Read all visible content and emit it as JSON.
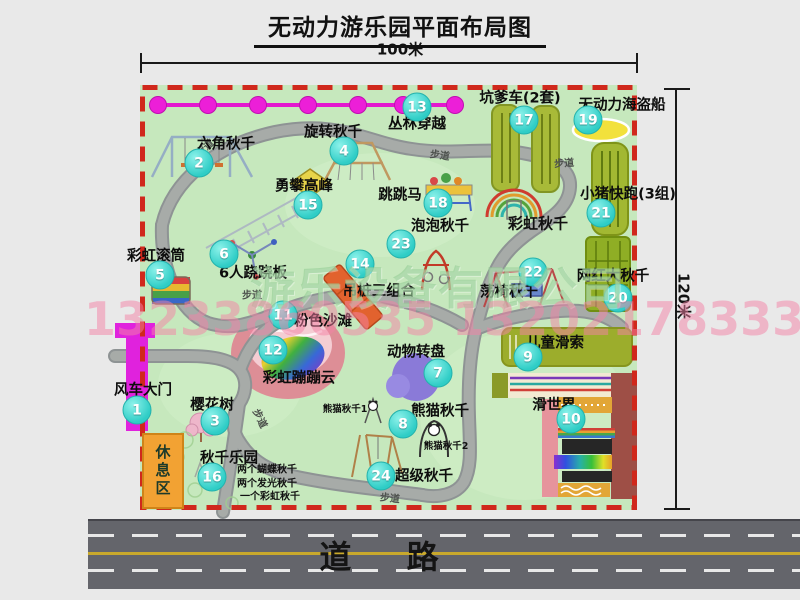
{
  "title": "无动力游乐园平面布局图",
  "dimensions": {
    "top": "100米",
    "right": "120米"
  },
  "road": {
    "label": "道 路"
  },
  "rest_area": {
    "label": "休息区"
  },
  "watermark": {
    "company": "游乐设备有限公司",
    "phone": "13233860535 13202178333"
  },
  "map": {
    "walkway_label": "步道",
    "walkway_label_positions": [
      {
        "x": 64,
        "y": 62,
        "rot": -42
      },
      {
        "x": 300,
        "y": 69,
        "rot": 8
      },
      {
        "x": 424,
        "y": 77,
        "rot": -4
      },
      {
        "x": 112,
        "y": 209,
        "rot": 0
      },
      {
        "x": 121,
        "y": 333,
        "rot": 64
      },
      {
        "x": 250,
        "y": 412,
        "rot": 6
      }
    ],
    "markers": [
      {
        "num": "1",
        "label": "风车大门",
        "lx": 3,
        "ly": 304,
        "cx": -3,
        "cy": 325
      },
      {
        "num": "2",
        "label": "六角秋千",
        "lx": 86,
        "ly": 58,
        "cx": 59,
        "cy": 78
      },
      {
        "num": "3",
        "label": "樱花树",
        "lx": 72,
        "ly": 319,
        "cx": 75,
        "cy": 336
      },
      {
        "num": "4",
        "label": "旋转秋千",
        "lx": 193,
        "ly": 46,
        "cx": 204,
        "cy": 66
      },
      {
        "num": "5",
        "label": "彩虹滚筒",
        "lx": 16,
        "ly": 170,
        "cx": 20,
        "cy": 190
      },
      {
        "num": "6",
        "label": "6人跷跷板",
        "lx": 113,
        "ly": 187,
        "cx": 84,
        "cy": 169
      },
      {
        "num": "7",
        "label": "动物转盘",
        "lx": 276,
        "ly": 266,
        "cx": 298,
        "cy": 288
      },
      {
        "num": "8",
        "label": "熊猫秋千",
        "lx": 300,
        "ly": 325,
        "cx": 263,
        "cy": 339
      },
      {
        "num": "9",
        "label": "儿童滑索",
        "lx": 415,
        "ly": 257,
        "cx": 388,
        "cy": 272
      },
      {
        "num": "10",
        "label": "滑世界",
        "lx": 414,
        "ly": 319,
        "cx": 431,
        "cy": 334
      },
      {
        "num": "11",
        "label": "粉色沙滩",
        "lx": 183,
        "ly": 235,
        "cx": 143,
        "cy": 230
      },
      {
        "num": "12",
        "label": "彩虹蹦蹦云",
        "lx": 159,
        "ly": 292,
        "cx": 133,
        "cy": 265
      },
      {
        "num": "13",
        "label": "丛林穿越",
        "lx": 277,
        "ly": 38,
        "cx": 277,
        "cy": 22
      },
      {
        "num": "14",
        "label": "吊桩三组合",
        "lx": 239,
        "ly": 205,
        "cx": 220,
        "cy": 179
      },
      {
        "num": "15",
        "label": "勇攀高峰",
        "lx": 164,
        "ly": 100,
        "cx": 168,
        "cy": 120
      },
      {
        "num": "16",
        "label": "秋千乐园",
        "lx": 89,
        "ly": 372,
        "cx": 72,
        "cy": 392
      },
      {
        "num": "17",
        "label": "坑爹车(2套)",
        "lx": 380,
        "ly": 12,
        "cx": 384,
        "cy": 35
      },
      {
        "num": "18",
        "label": "跳跳马",
        "lx": 260,
        "ly": 109,
        "cx": 298,
        "cy": 118
      },
      {
        "num": "19",
        "label": "无动力海盗船",
        "lx": 482,
        "ly": 19,
        "cx": 448,
        "cy": 35
      },
      {
        "num": "20",
        "label": "网红大秋千",
        "lx": 473,
        "ly": 190,
        "cx": 478,
        "cy": 213
      },
      {
        "num": "21",
        "label": "小猪快跑(3组)",
        "lx": 488,
        "ly": 108,
        "cx": 461,
        "cy": 128
      },
      {
        "num": "22",
        "label": "荡椅秋千",
        "lx": 369,
        "ly": 206,
        "cx": 393,
        "cy": 187
      },
      {
        "num": "23",
        "label": "泡泡秋千",
        "lx": 300,
        "ly": 140,
        "cx": 261,
        "cy": 159
      },
      {
        "num": "24",
        "label": "超级秋千",
        "lx": 284,
        "ly": 390,
        "cx": 241,
        "cy": 391
      }
    ],
    "extra_labels": [
      {
        "text": "彩虹秋千",
        "x": 398,
        "y": 138,
        "size": 15,
        "bold": true
      },
      {
        "text": "熊猫秋千1",
        "x": 205,
        "y": 323,
        "size": 9.5
      },
      {
        "text": "熊猫秋千2",
        "x": 306,
        "y": 360,
        "size": 9.5
      },
      {
        "text": "两个蝴蝶秋千",
        "x": 97,
        "y": 383,
        "size": 10,
        "anchor": "left"
      },
      {
        "text": "两个发光秋千",
        "x": 97,
        "y": 397,
        "size": 10,
        "anchor": "left"
      },
      {
        "text": "一个彩虹秋千",
        "x": 100,
        "y": 410,
        "size": 10,
        "anchor": "left"
      }
    ]
  }
}
